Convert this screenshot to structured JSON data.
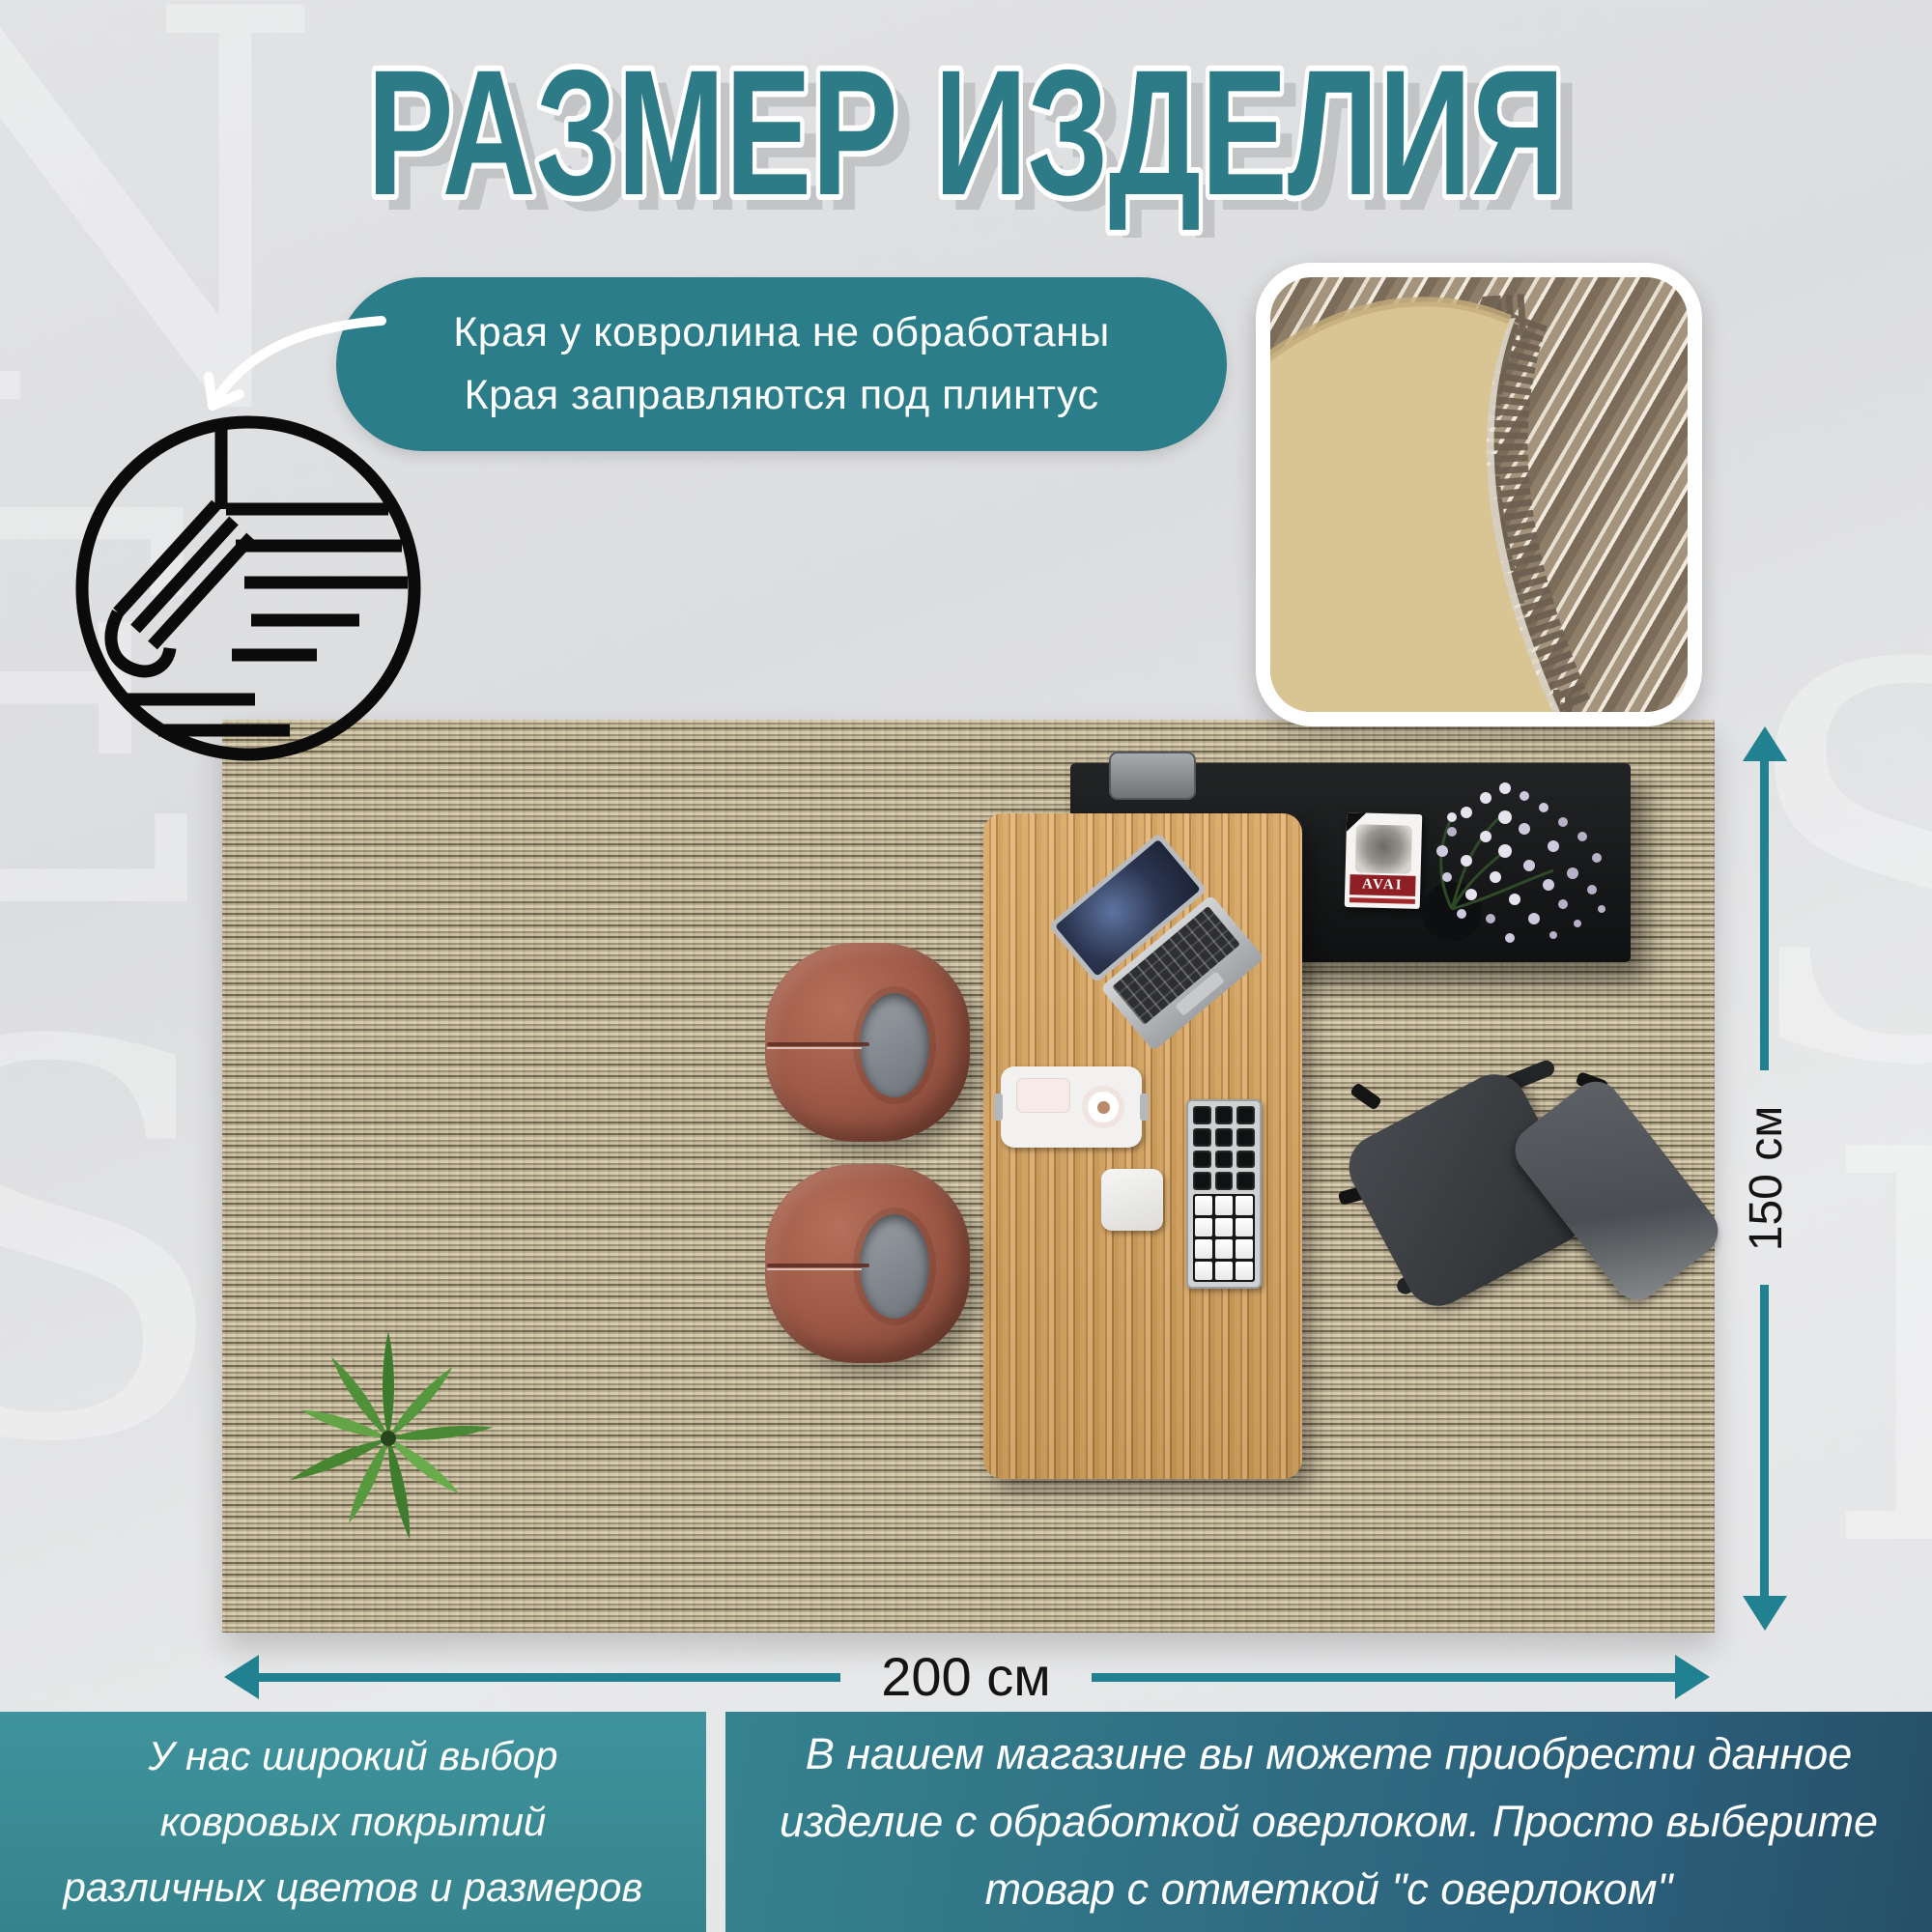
{
  "title": "РАЗМЕР ИЗДЕЛИЯ",
  "callout": {
    "line1": "Края у ковролина не обработаны",
    "line2": "Края заправляются под плинтус"
  },
  "dimensions": {
    "height_label": "150 см",
    "width_label": "200 см"
  },
  "book": {
    "title": "AVAI"
  },
  "footer": {
    "left_lines": [
      "У нас широкий выбор",
      "ковровых покрытий",
      "различных цветов и размеров"
    ],
    "right_lines": [
      "В нашем магазине вы можете приобрести данное",
      "изделие с обработкой оверлоком. Просто выберите",
      "товар с отметкой \"с оверлоком\""
    ]
  },
  "watermark": {
    "left": [
      "N",
      "E",
      "S"
    ],
    "right": [
      "S",
      "I"
    ]
  },
  "colors": {
    "title_teal": "#2c7b87",
    "bubble_teal": "#2a7d89",
    "arrow_teal": "#228190",
    "panel_left": "#3a8d96",
    "panel_right_start": "#35828f",
    "panel_right_end": "#264f68",
    "carpet_base": "#b3a78a",
    "desk_wood": "#cf9d58",
    "chair_terracotta": "#a05a47"
  }
}
